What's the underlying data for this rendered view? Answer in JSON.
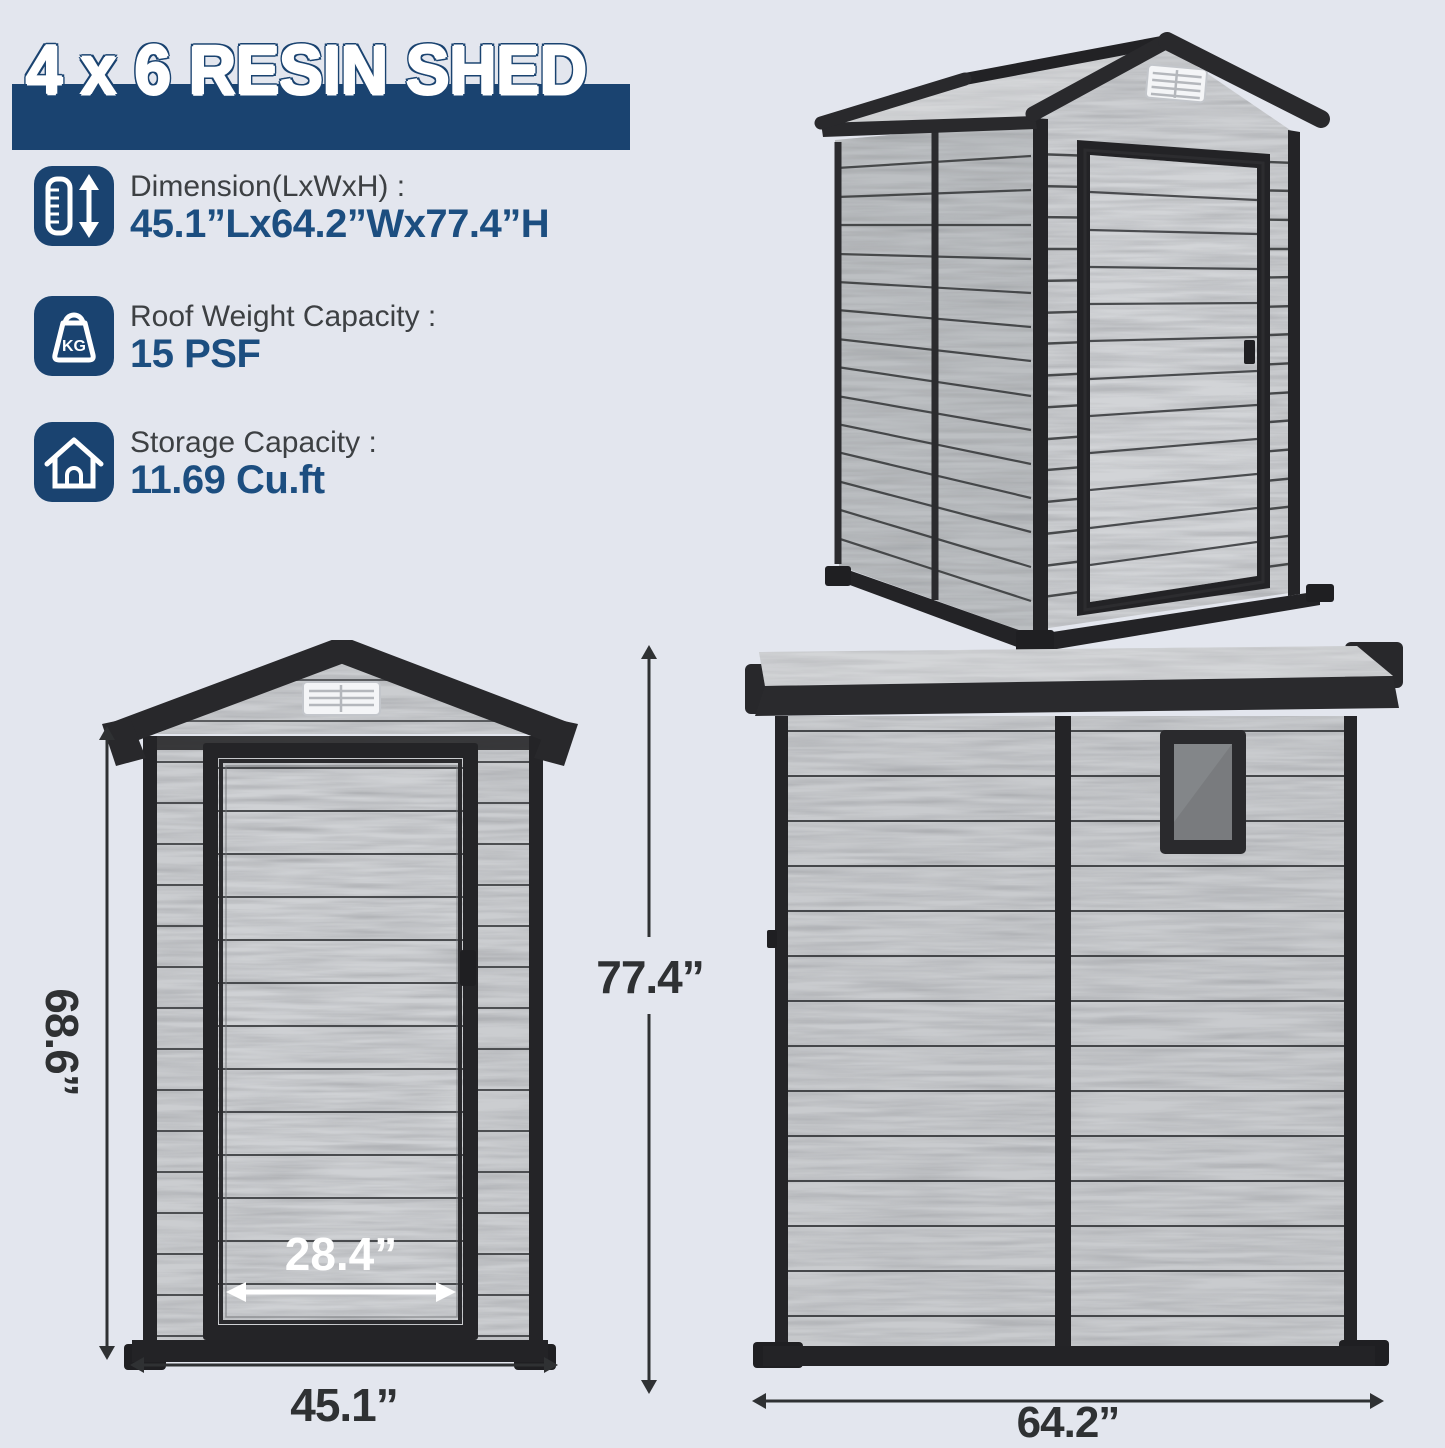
{
  "header": {
    "title": "4 x 6 RESIN SHED"
  },
  "specs": [
    {
      "icon": "height-dimension-icon",
      "label": "Dimension(LxWxH) :",
      "value": "45.1”Lx64.2”Wx77.4”H"
    },
    {
      "icon": "roof-weight-icon",
      "icon_text": "KG",
      "label": "Roof Weight Capacity :",
      "value": "15 PSF"
    },
    {
      "icon": "storage-house-icon",
      "label": "Storage Capacity :",
      "value": "11.69 Cu.ft"
    }
  ],
  "views": {
    "front": {
      "overall_height": "77.4”",
      "wall_height": "68.6”",
      "door_width": "28.4”",
      "overall_width": "45.1”"
    },
    "side": {
      "overall_width": "64.2”"
    }
  },
  "colors": {
    "background": "#e3e6ee",
    "navy": "#1a4370",
    "value_navy": "#1c4e80",
    "dimension_text": "#2f3133",
    "trim_dark": "#28282b",
    "plank_gray": "#cbcdd0"
  }
}
